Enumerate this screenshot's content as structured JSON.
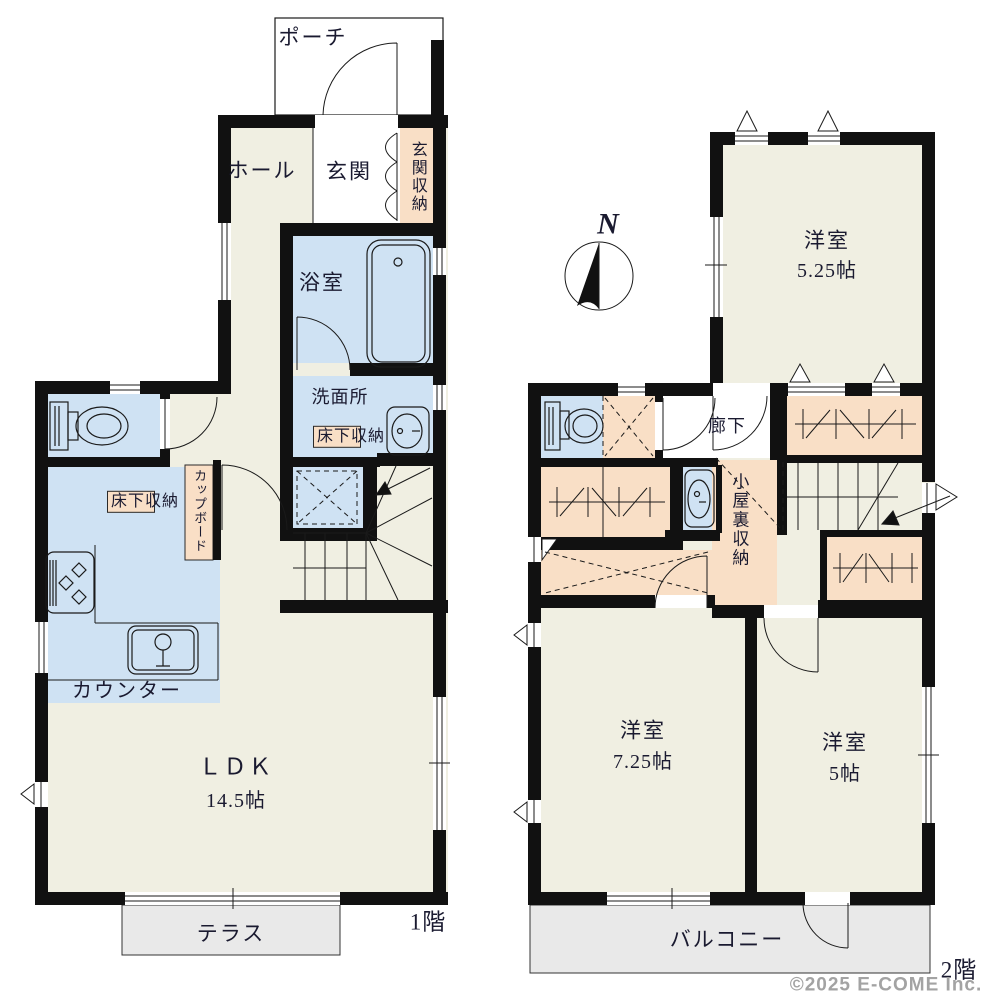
{
  "title": "間取り図",
  "floor1": {
    "name": "1階",
    "rooms": {
      "porch": "ポーチ",
      "hall": "ホール",
      "entrance": "玄関",
      "entrance_storage": "玄関収納",
      "bathroom": "浴室",
      "washroom": "洗面所",
      "washroom_underfloor_storage": "床下収納",
      "kitchen_underfloor_storage": "床下収納",
      "cupboard": "カップボード",
      "counter": "カウンター",
      "ldk": "ＬＤＫ",
      "ldk_size": "14.5帖",
      "terrace": "テラス"
    }
  },
  "floor2": {
    "name": "2階",
    "rooms": {
      "bedroom_a": "洋室",
      "bedroom_a_size": "5.25帖",
      "corridor": "廊下",
      "attic_storage": "小屋裏収納",
      "bedroom_b": "洋室",
      "bedroom_b_size": "7.25帖",
      "bedroom_c": "洋室",
      "bedroom_c_size": "5帖",
      "balcony": "バルコニー"
    }
  },
  "compass": {
    "north": "N"
  },
  "watermark": "©2025 E-COME Inc.",
  "colors": {
    "room_floor": "#f0efe2",
    "wet_area": "#cfe2f3",
    "storage": "#f9dfc6",
    "outdoor": "#e9e9e9",
    "wall": "#111111",
    "text": "#1a1a30",
    "watermark_text": "#a3a3a3"
  }
}
